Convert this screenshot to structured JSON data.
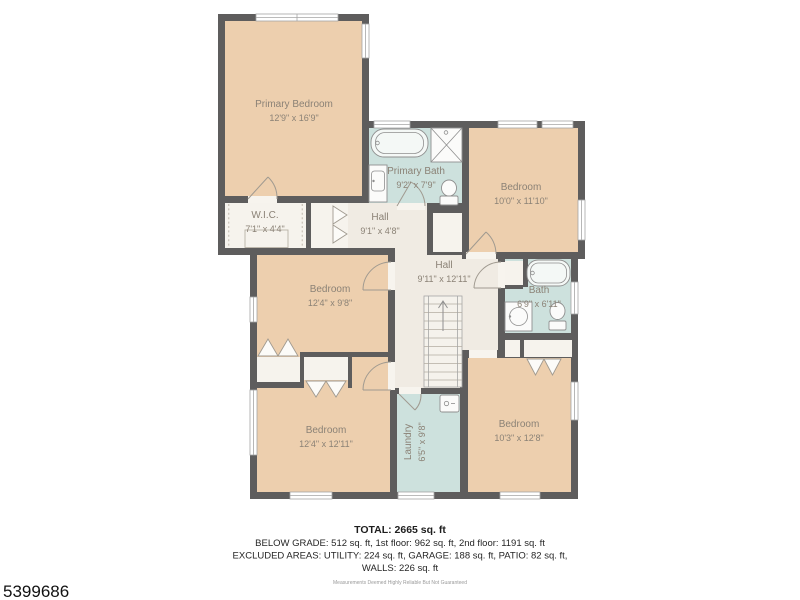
{
  "floorplan": {
    "rooms": [
      {
        "id": "primary-bedroom",
        "name": "Primary Bedroom",
        "dims": "12'9\" x 16'9\""
      },
      {
        "id": "primary-bath",
        "name": "Primary Bath",
        "dims": "9'2\" x 7'9\""
      },
      {
        "id": "bedroom-ne",
        "name": "Bedroom",
        "dims": "10'0\" x 11'10\""
      },
      {
        "id": "wic",
        "name": "W.I.C.",
        "dims": "7'1\" x 4'4\""
      },
      {
        "id": "hall-upper",
        "name": "Hall",
        "dims": "9'1\" x 4'8\""
      },
      {
        "id": "hall-main",
        "name": "Hall",
        "dims": "9'11\" x 12'11\""
      },
      {
        "id": "bath",
        "name": "Bath",
        "dims": "6'9\" x 6'11\""
      },
      {
        "id": "bedroom-west",
        "name": "Bedroom",
        "dims": "12'4\" x 9'8\""
      },
      {
        "id": "bedroom-southwest",
        "name": "Bedroom",
        "dims": "12'4\" x 12'11\""
      },
      {
        "id": "laundry",
        "name": "Laundry",
        "dims": "6'5\" x 9'8\""
      },
      {
        "id": "bedroom-southeast",
        "name": "Bedroom",
        "dims": "10'3\" x 12'8\""
      }
    ],
    "footer": {
      "total": "TOTAL: 2665 sq. ft",
      "grade_line": "BELOW GRADE: 512 sq. ft, 1st floor: 962 sq. ft, 2nd floor: 1191 sq. ft",
      "excluded_line": "EXCLUDED AREAS: UTILITY: 224 sq. ft, GARAGE: 188 sq. ft, PATIO: 82 sq. ft,",
      "walls_line": "WALLS: 226 sq. ft",
      "disclaimer": "Measurements Deemed Highly Reliable But Not Guaranteed"
    },
    "listing_id": "5399686",
    "colors": {
      "wall": "#5e5d5d",
      "bedroom_fill": "#edcfae",
      "wet_room_fill": "#cde1dd",
      "hall_fill": "#f0ebe3",
      "closet_fill": "#f6f3ed"
    }
  }
}
